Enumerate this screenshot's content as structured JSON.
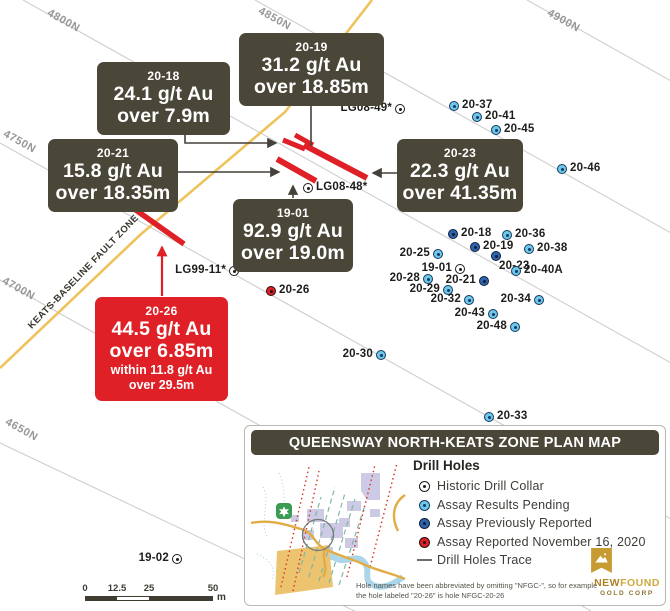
{
  "map": {
    "grid_labels": [
      {
        "text": "4800N",
        "x": 51,
        "y": 7
      },
      {
        "text": "4850N",
        "x": 262,
        "y": 5
      },
      {
        "text": "4900N",
        "x": 551,
        "y": 7
      },
      {
        "text": "4750N",
        "x": 7,
        "y": 128
      },
      {
        "text": "4700N",
        "x": 6,
        "y": 275
      },
      {
        "text": "4650N",
        "x": 9,
        "y": 416
      }
    ],
    "fault_label": "KEATS-BASELINE FAULT ZONE",
    "drill_holes": [
      {
        "label": "20-37",
        "type": "pending",
        "x": 454,
        "y": 106,
        "side": "right"
      },
      {
        "label": "20-41",
        "type": "pending",
        "x": 477,
        "y": 117,
        "side": "right"
      },
      {
        "label": "20-45",
        "type": "pending",
        "x": 496,
        "y": 130,
        "side": "right"
      },
      {
        "label": "20-46",
        "type": "pending",
        "x": 562,
        "y": 169,
        "side": "right"
      },
      {
        "label": "LG08-49*",
        "type": "historic",
        "x": 400,
        "y": 109,
        "side": "left"
      },
      {
        "label": "LG08-48*",
        "type": "historic",
        "x": 308,
        "y": 188,
        "side": "right"
      },
      {
        "label": "LG99-11*",
        "type": "historic",
        "x": 234,
        "y": 271,
        "side": "left"
      },
      {
        "label": "19-01",
        "type": "historic",
        "x": 460,
        "y": 269,
        "side": "left"
      },
      {
        "label": "19-02",
        "type": "historic",
        "x": 177,
        "y": 559,
        "side": "left"
      },
      {
        "label": "20-18",
        "type": "reported",
        "x": 453,
        "y": 234,
        "side": "right"
      },
      {
        "label": "20-36",
        "type": "pending",
        "x": 507,
        "y": 235,
        "side": "right"
      },
      {
        "label": "20-19",
        "type": "reported",
        "x": 475,
        "y": 247,
        "side": "right"
      },
      {
        "label": "20-38",
        "type": "pending",
        "x": 529,
        "y": 249,
        "side": "right"
      },
      {
        "label": "20-23",
        "type": "reported",
        "x": 496,
        "y": 256,
        "side": "below-right"
      },
      {
        "label": "20-25",
        "type": "pending",
        "x": 438,
        "y": 254,
        "side": "left"
      },
      {
        "label": "20-40A",
        "type": "pending",
        "x": 516,
        "y": 271,
        "side": "right"
      },
      {
        "label": "20-28",
        "type": "pending",
        "x": 428,
        "y": 279,
        "side": "left"
      },
      {
        "label": "20-21",
        "type": "reported",
        "x": 484,
        "y": 281,
        "side": "left"
      },
      {
        "label": "20-29",
        "type": "pending",
        "x": 448,
        "y": 290,
        "side": "left"
      },
      {
        "label": "20-32",
        "type": "pending",
        "x": 469,
        "y": 300,
        "side": "left"
      },
      {
        "label": "20-34",
        "type": "pending",
        "x": 539,
        "y": 300,
        "side": "left"
      },
      {
        "label": "20-43",
        "type": "pending",
        "x": 493,
        "y": 314,
        "side": "left"
      },
      {
        "label": "20-48",
        "type": "pending",
        "x": 515,
        "y": 327,
        "side": "left"
      },
      {
        "label": "20-26",
        "type": "red",
        "x": 271,
        "y": 291,
        "side": "right"
      },
      {
        "label": "20-30",
        "type": "pending",
        "x": 381,
        "y": 355,
        "side": "left"
      },
      {
        "label": "20-33",
        "type": "pending",
        "x": 489,
        "y": 417,
        "side": "right"
      }
    ],
    "callouts": [
      {
        "id": "20-18",
        "grade": "24.1 g/t Au",
        "interval": "over 7.9m",
        "variant": "dark",
        "x": 97,
        "y": 62,
        "w": 133
      },
      {
        "id": "20-19",
        "grade": "31.2 g/t Au",
        "interval": "over 18.85m",
        "variant": "dark",
        "x": 239,
        "y": 33,
        "w": 145
      },
      {
        "id": "20-21",
        "grade": "15.8 g/t Au",
        "interval": "over 18.35m",
        "variant": "dark",
        "x": 48,
        "y": 139,
        "w": 130
      },
      {
        "id": "20-23",
        "grade": "22.3 g/t Au",
        "interval": "over 41.35m",
        "variant": "dark",
        "x": 397,
        "y": 139,
        "w": 126
      },
      {
        "id": "19-01",
        "grade": "92.9 g/t Au",
        "interval": "over 19.0m",
        "variant": "dark",
        "x": 233,
        "y": 199,
        "w": 120
      },
      {
        "id": "20-26",
        "grade": "44.5 g/t Au",
        "interval": "over 6.85m",
        "within_grade": "within 11.8 g/t Au",
        "within_interval": "over 29.5m",
        "variant": "red",
        "x": 95,
        "y": 297,
        "w": 133
      }
    ],
    "scale_bar": {
      "ticks": [
        "0",
        "12.5",
        "25",
        "50"
      ],
      "unit": "m"
    }
  },
  "legend": {
    "title": "QUEENSWAY NORTH-KEATS ZONE PLAN MAP",
    "section_header": "Drill Holes",
    "items": [
      {
        "type": "historic",
        "label": "Historic Drill Collar"
      },
      {
        "type": "pending",
        "label": "Assay Results Pending"
      },
      {
        "type": "reported",
        "label": "Assay Previously Reported"
      },
      {
        "type": "redlegend",
        "label": "Assay Reported November 16, 2020"
      },
      {
        "type": "trace",
        "label": "Drill Holes Trace"
      }
    ],
    "note_line1": "Hole names have been abbreviated by omitting \"NFGC-\", so for example",
    "note_line2": "the hole labeled \"20-26\" is hole NFGC-20-26",
    "logo": {
      "name_bold": "NEW",
      "name_light": "FOUND",
      "subtitle": "GOLD CORP"
    }
  },
  "colors": {
    "callout_dark": "#4a4638",
    "callout_red": "#df2127",
    "fault_line": "#efc35c",
    "grid_line": "#cfcfcf",
    "pending_fill": "#6dc8ec",
    "reported_fill": "#2e64ab",
    "red_fill": "#d92027",
    "historic_fill": "#ffffff",
    "trace_red": "#df2127",
    "leader_line": "#45413a"
  }
}
